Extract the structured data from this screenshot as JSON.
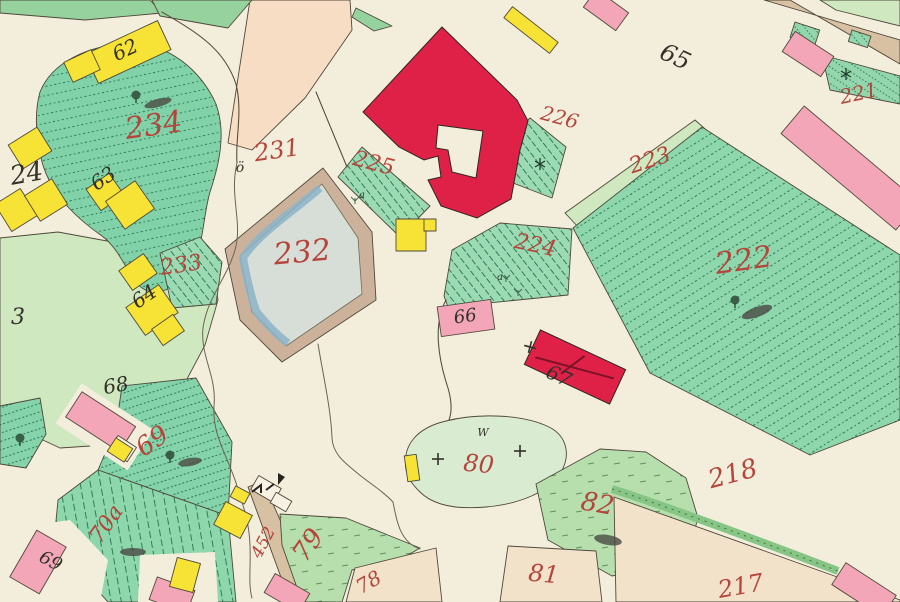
{
  "title": "Scanned historical cadastral map sheet",
  "palette": {
    "paper_cream": "#f3eedb",
    "field_peach": "#f7ddc4",
    "field_beige": "#f2e2ca",
    "meadow_light_green": "#cfe8c0",
    "garden_teal": "#8ed7ad",
    "hatch_dark_green": "#2c7a54",
    "building_masonry_red": "#df2148",
    "building_masonry_pink": "#f3a6b8",
    "building_wood_yellow": "#f7e335",
    "water_edge_blue": "#8cb4c9",
    "water_fill": "#d7ded7",
    "road_tan": "#d7c1a2",
    "embankment_tan": "#ccb29b",
    "ink_red": "#b5443a",
    "ink_black": "#33312a"
  },
  "red_labels": {
    "p217": "217",
    "p218": "218",
    "p221": "221",
    "p222": "222",
    "p223": "223",
    "p224": "224",
    "p225": "225",
    "p226": "226",
    "p231": "231",
    "p232": "232",
    "p233": "233",
    "p234": "234",
    "p69": "69",
    "p70a": "70a",
    "p78": "78",
    "p79": "79",
    "p80": "80",
    "p81": "81",
    "p82": "82",
    "road": "452"
  },
  "black_labels": {
    "h3": "3",
    "h24": "24",
    "h62": "62",
    "h63": "63",
    "h64": "64",
    "h65": "65",
    "h66": "66",
    "h67": "67",
    "h68": "68",
    "h69": "69"
  },
  "symbols": {
    "oe": "ö",
    "w": "W",
    "a1": "a",
    "a2": "a"
  }
}
